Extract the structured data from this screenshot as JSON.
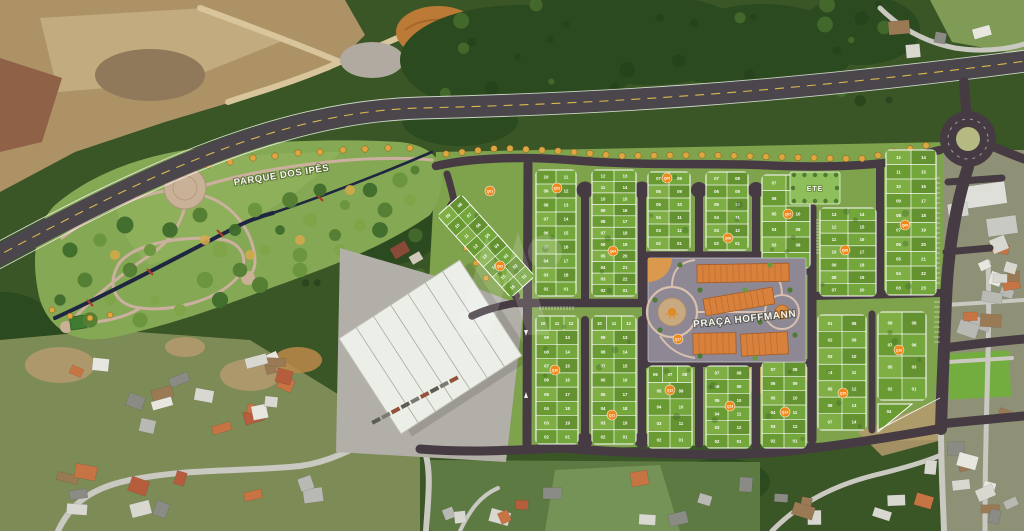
{
  "map": {
    "type": "masterplan-aerial",
    "description": "Aerial satellite view with land subdivision masterplan overlay"
  },
  "labels": {
    "park": "PARQUE DOS IPÊS",
    "plaza": "PRAÇA HOFFMANN",
    "ete": "ETE"
  },
  "colors": {
    "road_new": "#463b42",
    "highway": "#4a464b",
    "road_old": "#c9c8c1",
    "center_line": "#dcb94e",
    "lot_green": "#6a9b33",
    "lot_greens": [
      "#6a9b33",
      "#73a63b",
      "#7fae45",
      "#659230"
    ],
    "lot_line": "#ffffff",
    "badge_orange": "#ee8a1d",
    "building_orange": "#d8813c",
    "plaza_ground": "#8d8894",
    "plaza_path": "#d9bfae",
    "park_meadow": "#85a855",
    "park_path": "#ccb09f",
    "creek": "#1f2740",
    "ete_green": "#8fbf5a",
    "street_tree": "#dfa63f",
    "warehouse_roof": "#eceee8"
  },
  "ete_area": {
    "x": 790,
    "y": 172,
    "w": 50,
    "h": 32
  },
  "badges": [
    {
      "id": "Q01",
      "x": 490,
      "y": 191
    },
    {
      "id": "Q02",
      "x": 500,
      "y": 266
    },
    {
      "id": "Q03",
      "x": 557,
      "y": 188
    },
    {
      "id": "Q04",
      "x": 613,
      "y": 251
    },
    {
      "id": "Q05",
      "x": 667,
      "y": 178
    },
    {
      "id": "Q06",
      "x": 728,
      "y": 238
    },
    {
      "id": "Q07",
      "x": 788,
      "y": 214
    },
    {
      "id": "Q08",
      "x": 845,
      "y": 250
    },
    {
      "id": "Q09",
      "x": 905,
      "y": 225
    },
    {
      "id": "Q10",
      "x": 555,
      "y": 370
    },
    {
      "id": "Q11",
      "x": 612,
      "y": 415
    },
    {
      "id": "Q12",
      "x": 670,
      "y": 390
    },
    {
      "id": "Q13",
      "x": 730,
      "y": 406
    },
    {
      "id": "Q14",
      "x": 785,
      "y": 412
    },
    {
      "id": "Q15",
      "x": 843,
      "y": 393
    },
    {
      "id": "Q16",
      "x": 899,
      "y": 350
    },
    {
      "id": "Q17",
      "x": 678,
      "y": 339
    }
  ],
  "blocks": [
    {
      "id": "Q01-Q02",
      "x": 470,
      "y": 191,
      "w": 32,
      "h": 110,
      "rot": -42,
      "rows": [
        [
          "09",
          "08"
        ],
        [
          "10",
          "07"
        ],
        [
          "11",
          "06"
        ],
        [
          "12",
          "05"
        ],
        [
          "13",
          "04"
        ],
        [
          "14",
          "03"
        ],
        [
          "15",
          "02"
        ],
        [
          "16",
          "01"
        ]
      ]
    },
    {
      "id": "Q03",
      "x": 536,
      "y": 170,
      "w": 40,
      "h": 126,
      "rows": [
        [
          "10",
          "11"
        ],
        [
          "09",
          "12"
        ],
        [
          "08",
          "13"
        ],
        [
          "07",
          "14"
        ],
        [
          "06",
          "15"
        ],
        [
          "05",
          "16"
        ],
        [
          "04",
          "17"
        ],
        [
          "03",
          "18"
        ],
        [
          "02",
          "01"
        ]
      ]
    },
    {
      "id": "Q04",
      "x": 592,
      "y": 170,
      "w": 44,
      "h": 126,
      "rows": [
        [
          "12",
          "13"
        ],
        [
          "11",
          "14"
        ],
        [
          "10",
          "15"
        ],
        [
          "09",
          "16"
        ],
        [
          "08",
          "17"
        ],
        [
          "07",
          "18"
        ],
        [
          "06",
          "19"
        ],
        [
          "05",
          "20"
        ],
        [
          "04",
          "21"
        ],
        [
          "03",
          "22"
        ],
        [
          "02",
          "01"
        ]
      ]
    },
    {
      "id": "Q05",
      "x": 648,
      "y": 172,
      "w": 42,
      "h": 78,
      "rows": [
        [
          "07",
          "08"
        ],
        [
          "06",
          "09"
        ],
        [
          "05",
          "10"
        ],
        [
          "04",
          "11"
        ],
        [
          "03",
          "12"
        ],
        [
          "02",
          "01"
        ]
      ]
    },
    {
      "id": "Q06",
      "x": 706,
      "y": 172,
      "w": 42,
      "h": 78,
      "rows": [
        [
          "07",
          "08"
        ],
        [
          "06",
          "09"
        ],
        [
          "05",
          "10"
        ],
        [
          "04",
          "11"
        ],
        [
          "03",
          "12"
        ],
        [
          "02",
          "01"
        ]
      ]
    },
    {
      "id": "Q07",
      "x": 762,
      "y": 175,
      "w": 48,
      "h": 93,
      "rows": [
        [
          "07",
          ""
        ],
        [
          "06",
          ""
        ],
        [
          "05",
          "10"
        ],
        [
          "04",
          "09"
        ],
        [
          "03",
          "08"
        ],
        [
          "02",
          "01"
        ]
      ]
    },
    {
      "id": "Q08",
      "x": 820,
      "y": 208,
      "w": 56,
      "h": 88,
      "rows": [
        [
          "13",
          "14"
        ],
        [
          "12",
          "15"
        ],
        [
          "11",
          "16"
        ],
        [
          "10",
          "17"
        ],
        [
          "09",
          "18"
        ],
        [
          "08",
          "19"
        ],
        [
          "07",
          "20"
        ]
      ]
    },
    {
      "id": "Q09",
      "x": 886,
      "y": 150,
      "w": 50,
      "h": 145,
      "rows": [
        [
          "12",
          "14"
        ],
        [
          "11",
          "15"
        ],
        [
          "10",
          "16"
        ],
        [
          "09",
          "17"
        ],
        [
          "08",
          "18"
        ],
        [
          "07",
          "19"
        ],
        [
          "06",
          "20"
        ],
        [
          "05",
          "21"
        ],
        [
          "04",
          "22"
        ],
        [
          "03",
          "23"
        ]
      ]
    },
    {
      "id": "Q10",
      "x": 536,
      "y": 316,
      "w": 42,
      "h": 128,
      "rows": [
        [
          "10",
          "11",
          "12"
        ],
        [
          "09",
          "13"
        ],
        [
          "08",
          "14"
        ],
        [
          "07",
          "15"
        ],
        [
          "06",
          "16"
        ],
        [
          "05",
          "17"
        ],
        [
          "04",
          "18"
        ],
        [
          "03",
          "19"
        ],
        [
          "02",
          "01"
        ]
      ]
    },
    {
      "id": "Q11",
      "x": 592,
      "y": 316,
      "w": 44,
      "h": 128,
      "rows": [
        [
          "10",
          "11",
          "12"
        ],
        [
          "09",
          "13"
        ],
        [
          "08",
          "14"
        ],
        [
          "07",
          "15"
        ],
        [
          "06",
          "16"
        ],
        [
          "05",
          "17"
        ],
        [
          "04",
          "18"
        ],
        [
          "03",
          "19"
        ],
        [
          "02",
          "01"
        ]
      ]
    },
    {
      "id": "Q12",
      "x": 648,
      "y": 366,
      "w": 44,
      "h": 82,
      "rows": [
        [
          "06",
          "07",
          "08"
        ],
        [
          "05",
          "09"
        ],
        [
          "04",
          "10"
        ],
        [
          "03",
          "11"
        ],
        [
          "02",
          "01"
        ]
      ]
    },
    {
      "id": "Q13",
      "x": 706,
      "y": 366,
      "w": 44,
      "h": 82,
      "rows": [
        [
          "07",
          "08"
        ],
        [
          "06",
          "09"
        ],
        [
          "05",
          "10"
        ],
        [
          "04",
          "11"
        ],
        [
          "03",
          "12"
        ],
        [
          "02",
          "01"
        ]
      ]
    },
    {
      "id": "Q14",
      "x": 762,
      "y": 362,
      "w": 44,
      "h": 86,
      "rows": [
        [
          "07",
          "08"
        ],
        [
          "06",
          "09"
        ],
        [
          "05",
          "10"
        ],
        [
          "04",
          "11"
        ],
        [
          "03",
          "12"
        ],
        [
          "02",
          "01"
        ]
      ]
    },
    {
      "id": "Q15",
      "x": 818,
      "y": 315,
      "w": 48,
      "h": 115,
      "rows": [
        [
          "01",
          "08"
        ],
        [
          "02",
          "09"
        ],
        [
          "03",
          "10"
        ],
        [
          "04",
          "11"
        ],
        [
          "05",
          "12"
        ],
        [
          "06",
          "13"
        ],
        [
          "07",
          "14"
        ]
      ]
    },
    {
      "id": "Q16",
      "x": 878,
      "y": 312,
      "w": 48,
      "h": 88,
      "rows": [
        [
          "09",
          "08"
        ],
        [
          "07",
          "06"
        ],
        [
          "05",
          "03"
        ],
        [
          "02",
          "01"
        ]
      ]
    }
  ],
  "extra_lot": {
    "label": "04",
    "points": "878,404 912,404 878,432"
  }
}
